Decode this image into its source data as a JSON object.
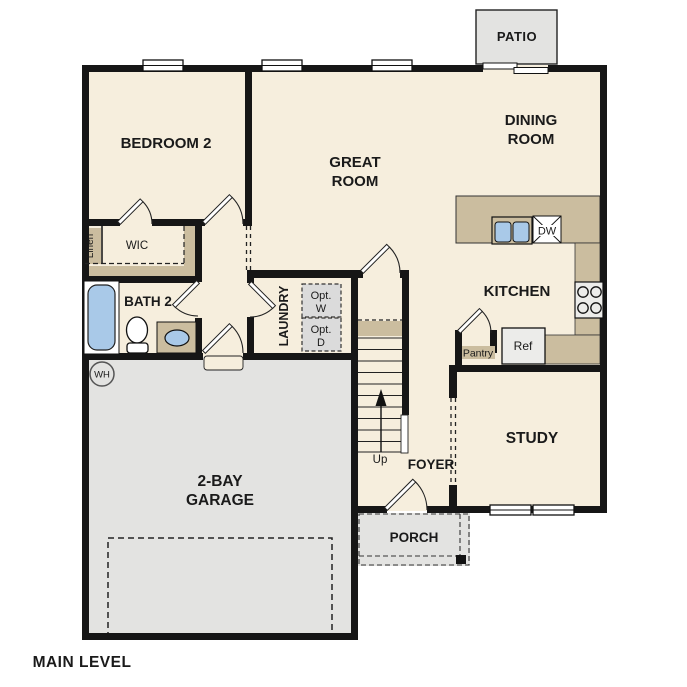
{
  "plan": {
    "title": "MAIN LEVEL",
    "rooms": {
      "patio": "PATIO",
      "dining": {
        "l1": "DINING",
        "l2": "ROOM"
      },
      "great": {
        "l1": "GREAT",
        "l2": "ROOM"
      },
      "bedroom2": "BEDROOM 2",
      "wic": "WIC",
      "linen": "Linen",
      "bath2": "BATH 2",
      "laundry": "LAUNDRY",
      "kitchen": "KITCHEN",
      "study": "STUDY",
      "foyer": "FOYER",
      "porch": "PORCH",
      "garage": {
        "l1": "2-BAY",
        "l2": "GARAGE"
      }
    },
    "fixtures": {
      "dishwasher": "DW",
      "refrigerator": "Ref",
      "pantry": "Pantry",
      "water_heater": "WH",
      "stairs_up": "Up",
      "opt_washer": {
        "l1": "Opt.",
        "l2": "W"
      },
      "opt_dryer": {
        "l1": "Opt.",
        "l2": "D"
      }
    },
    "colors": {
      "floor_cream": "#f6eedd",
      "counter_tan": "#cbbd9f",
      "concrete_gray": "#e3e3e1",
      "fixture_blue": "#a9c9e8",
      "appliance_gray": "#ececea",
      "wall_black": "#161616"
    }
  }
}
